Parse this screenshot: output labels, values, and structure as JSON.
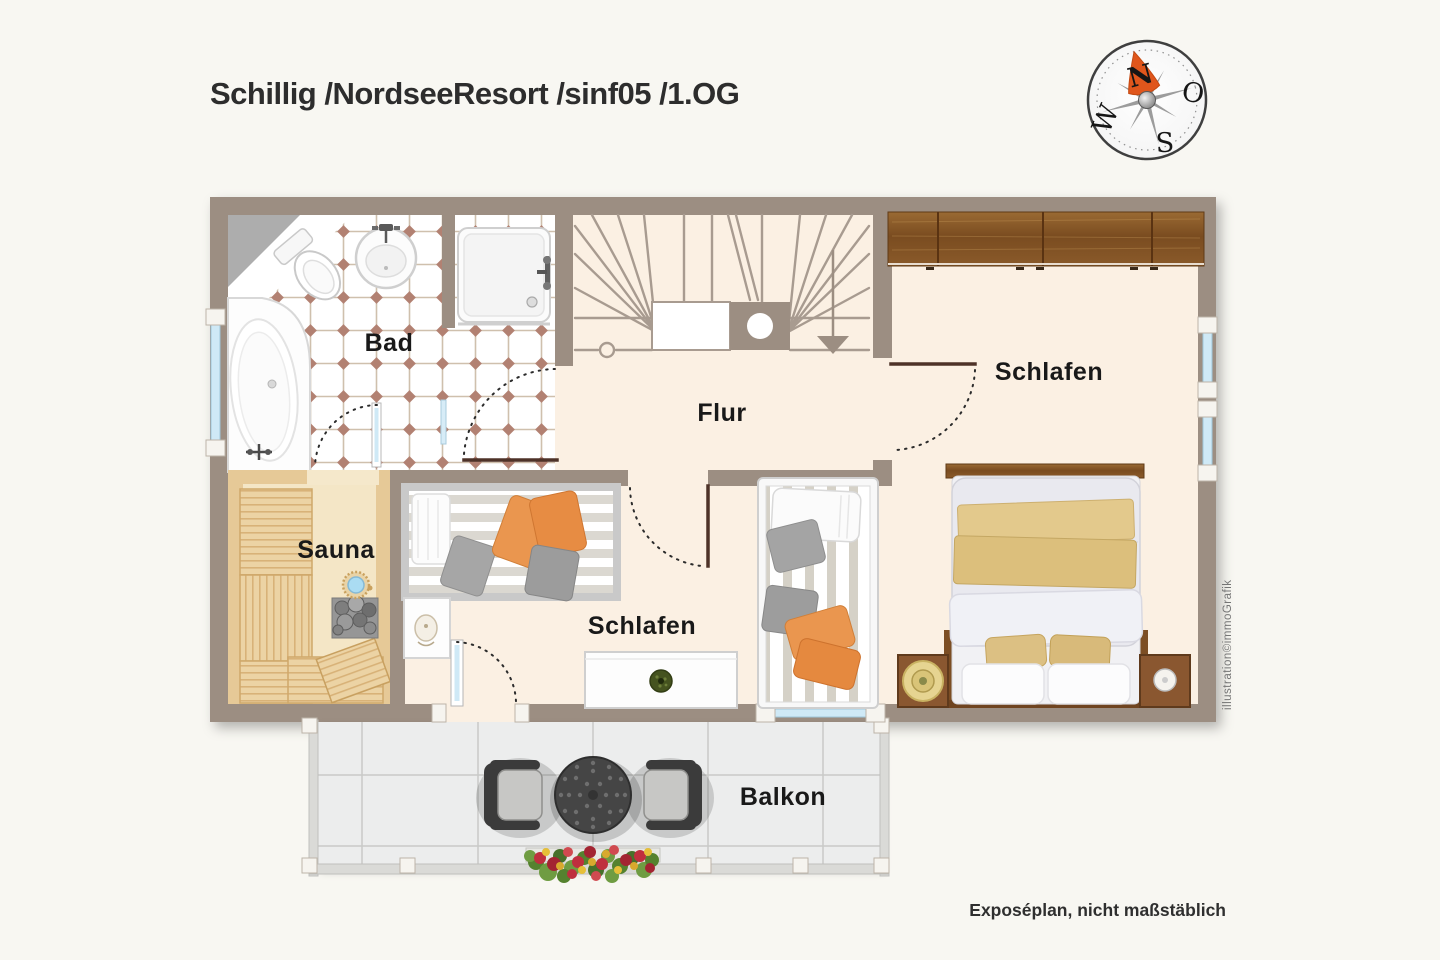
{
  "header": {
    "title": "Schillig /NordseeResort /sinf05 /1.OG"
  },
  "compass": {
    "north": "N",
    "east": "O",
    "south": "S",
    "west": "W"
  },
  "rooms": {
    "bad": "Bad",
    "flur": "Flur",
    "schlafen_right": "Schlafen",
    "schlafen_middle": "Schlafen",
    "sauna": "Sauna",
    "balkon": "Balkon"
  },
  "footer": {
    "note": "Exposéplan, nicht maßstäblich"
  },
  "watermark": "illustration©immoGrafik",
  "colors": {
    "wall": "#9c8e82",
    "floor": "#fbf0e3",
    "bath_tile_accent": "#b28172",
    "sauna_wood": "#e6c997",
    "furniture_wood": "#7c4e24",
    "textile_orange": "#ea964f",
    "textile_gold": "#dec27f",
    "compass_north": "#e0561c",
    "balcony_tile": "#eceded"
  }
}
